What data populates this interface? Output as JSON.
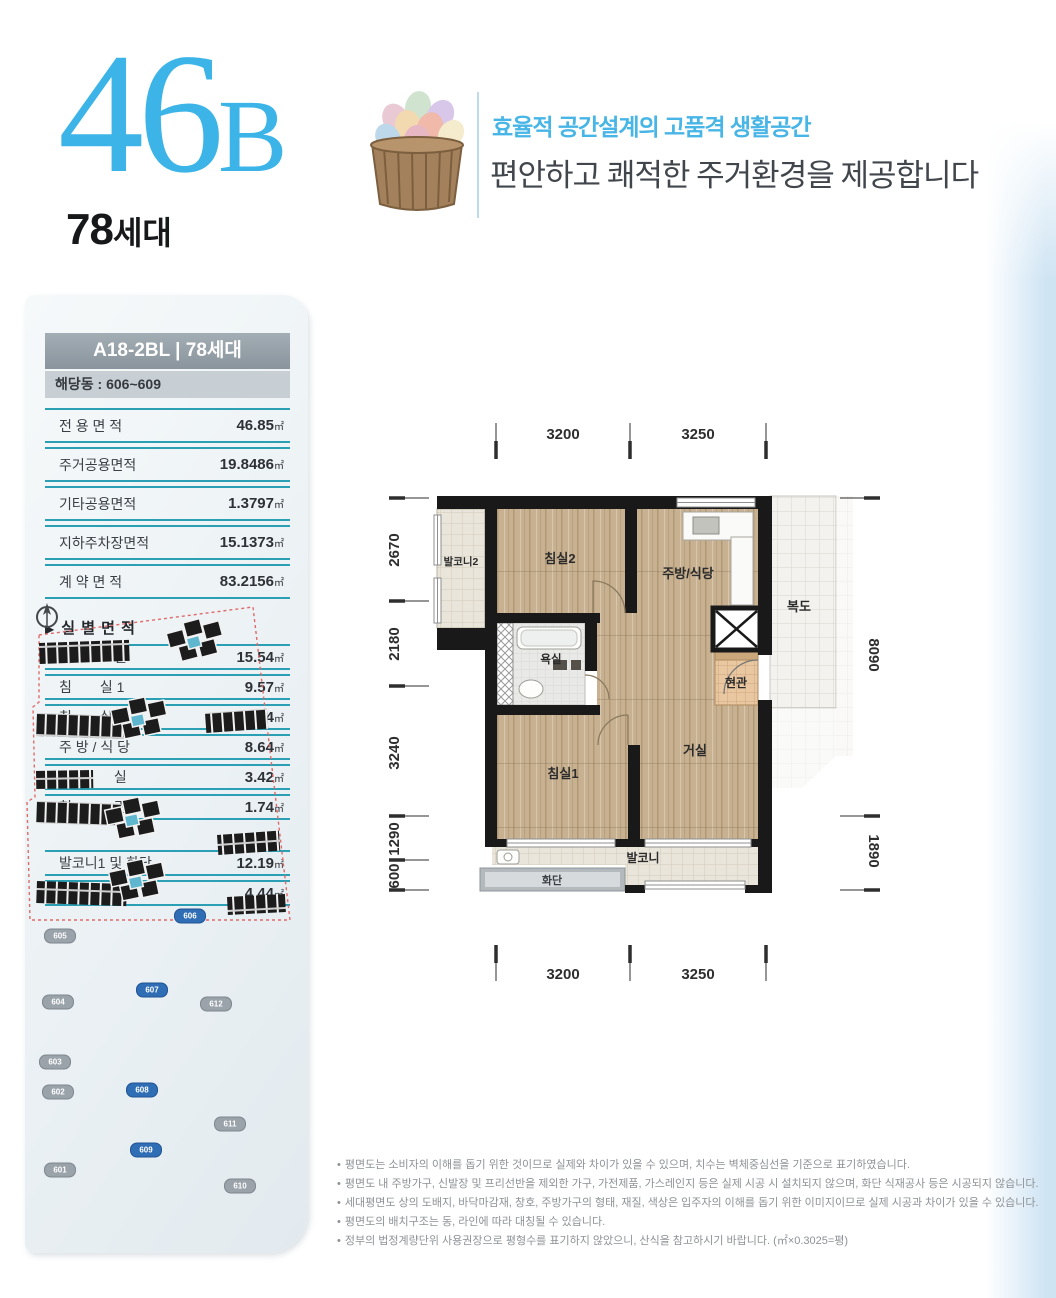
{
  "header": {
    "unit_code_main": "46",
    "unit_code_suffix": "B",
    "households_number": "78",
    "households_suffix": "세대",
    "tagline_blue": "효율적 공간설계의 고품격 생활공간",
    "tagline_main": "편안하고 쾌적한 주거환경을 제공합니다"
  },
  "info_table": {
    "title": "A18-2BL | 78세대",
    "subtitle": "해당동 : 606~609",
    "area_rows": [
      {
        "label": "전 용 면 적",
        "value": "46.85",
        "unit": "㎡"
      },
      {
        "label": "주거공용면적",
        "value": "19.8486",
        "unit": "㎡"
      },
      {
        "label": "기타공용면적",
        "value": "1.3797",
        "unit": "㎡"
      },
      {
        "label": "지하주차장면적",
        "value": "15.1373",
        "unit": "㎡"
      },
      {
        "label": "계 약 면 적",
        "value": "83.2156",
        "unit": "㎡"
      }
    ],
    "section_marker": "▶",
    "section_title": "실 별 면 적",
    "room_rows": [
      {
        "label": "거　　　실",
        "value": "15.54",
        "unit": "㎡"
      },
      {
        "label": "침　　실 1",
        "value": "9.57",
        "unit": "㎡"
      },
      {
        "label": "침　　실 2",
        "value": "7.94",
        "unit": "㎡"
      },
      {
        "label": "주 방 / 식 당",
        "value": "8.64",
        "unit": "㎡"
      },
      {
        "label": "욕　　　실",
        "value": "3.42",
        "unit": "㎡"
      },
      {
        "label": "현　　　관",
        "value": "1.74",
        "unit": "㎡"
      }
    ],
    "balcony_rows": [
      {
        "label": "발코니1 및 화단",
        "value": "12.19",
        "unit": "㎡"
      },
      {
        "label": "발 코 니 2",
        "value": "4.44",
        "unit": "㎡"
      }
    ]
  },
  "floor_plan": {
    "rooms": {
      "bedroom2": "침실2",
      "kitchen_dining": "주방/식당",
      "corridor": "복도",
      "balcony2": "발코니2",
      "bathroom": "욕실",
      "entrance": "현관",
      "bedroom1": "침실1",
      "living": "거실",
      "balcony": "발코니",
      "flower_bed": "화단"
    },
    "dims": {
      "top": [
        "3200",
        "3250"
      ],
      "bottom": [
        "3200",
        "3250"
      ],
      "left": [
        "2670",
        "2180",
        "3240",
        "1290",
        "600"
      ],
      "right": [
        "8090",
        "1890"
      ]
    }
  },
  "site_plan": {
    "buildings": [
      {
        "id": "605",
        "highlight": false
      },
      {
        "id": "606",
        "highlight": true
      },
      {
        "id": "604",
        "highlight": false
      },
      {
        "id": "607",
        "highlight": true
      },
      {
        "id": "612",
        "highlight": false
      },
      {
        "id": "603",
        "highlight": false
      },
      {
        "id": "602",
        "highlight": false
      },
      {
        "id": "608",
        "highlight": true
      },
      {
        "id": "611",
        "highlight": false
      },
      {
        "id": "601",
        "highlight": false
      },
      {
        "id": "609",
        "highlight": true
      },
      {
        "id": "610",
        "highlight": false
      }
    ]
  },
  "footnotes": [
    "평면도는 소비자의 이해를 돕기 위한 것이므로 실제와 차이가 있을 수 있으며, 치수는 벽체중심선을 기준으로 표기하였습니다.",
    "평면도 내 주방가구, 신발장 및 프리선반을 제외한 가구, 가전제품, 가스레인지 등은 실제 시공 시 설치되지 않으며, 화단 식재공사 등은 시공되지 않습니다.",
    "세대평면도 상의 도배지, 바닥마감재, 창호, 주방가구의 형태, 재질, 색상은 입주자의 이해를 돕기 위한 이미지이므로 실제 시공과 차이가 있을 수 있습니다.",
    "평면도의 배치구조는 동, 라인에 따라 대칭될 수 있습니다.",
    "정부의 법정계량단위 사용권장으로 평형수를 표기하지 않았으니, 산식을 참고하시기 바랍니다. (㎡×0.3025=평)"
  ],
  "colors": {
    "accent_blue": "#3cb4e8",
    "table_line_teal": "#2b9fb3",
    "badge_blue": "#2f6db5",
    "badge_gray": "#9aa2aa",
    "boundary_red": "#e06a6a",
    "wood_floor": "#c8b191",
    "wall_black": "#191919"
  }
}
